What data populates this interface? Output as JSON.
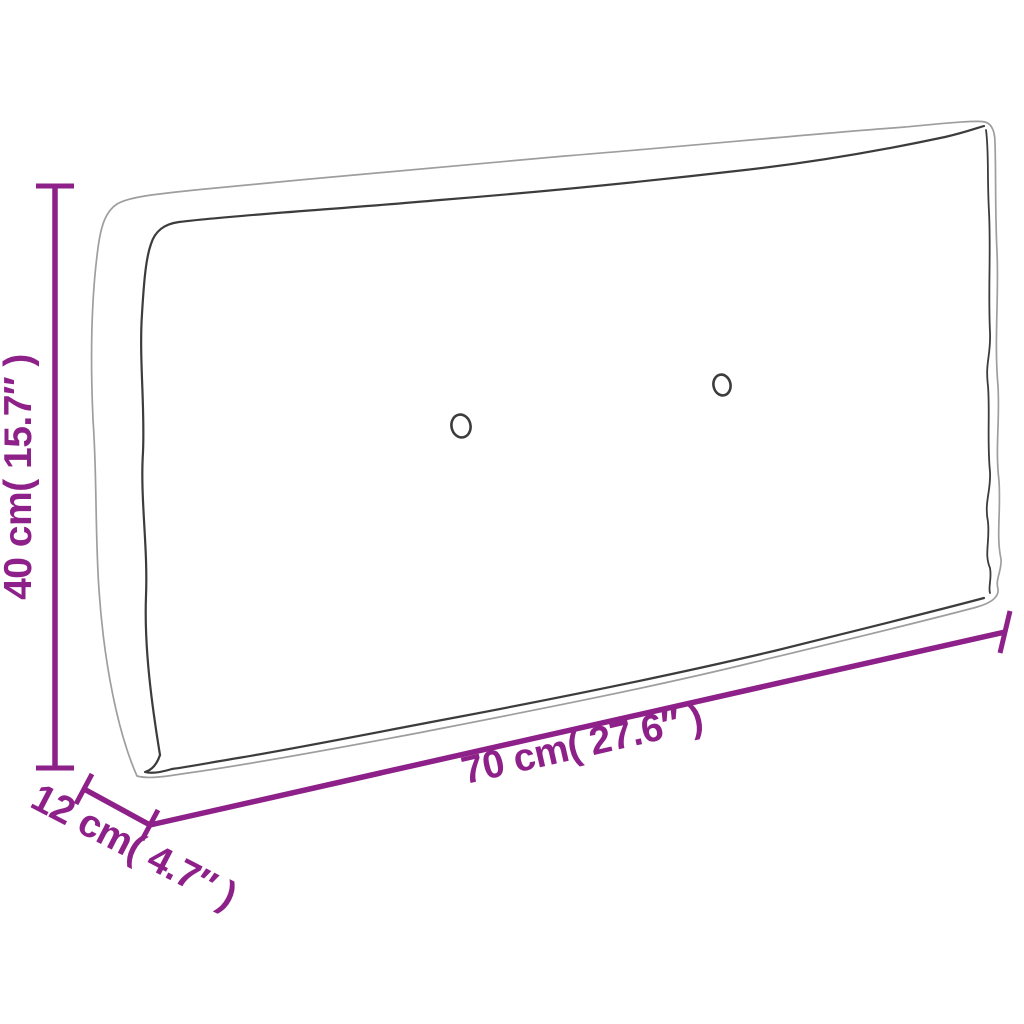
{
  "diagram": {
    "object_name": "pallet-cushion-line-drawing",
    "dimensions": {
      "height": {
        "label": "40 cm( 15.7″ )"
      },
      "width": {
        "label": "70 cm( 27.6″ )"
      },
      "depth": {
        "label": "12 cm( 4.7″ )"
      }
    },
    "buttons": {
      "left": "tuft-button",
      "right": "tuft-button"
    }
  },
  "colors": {
    "dimension_accent": "#8E2189",
    "outline_light": "#9E9E9E",
    "outline_dark": "#3C3C3C",
    "background": "#FFFFFF"
  }
}
